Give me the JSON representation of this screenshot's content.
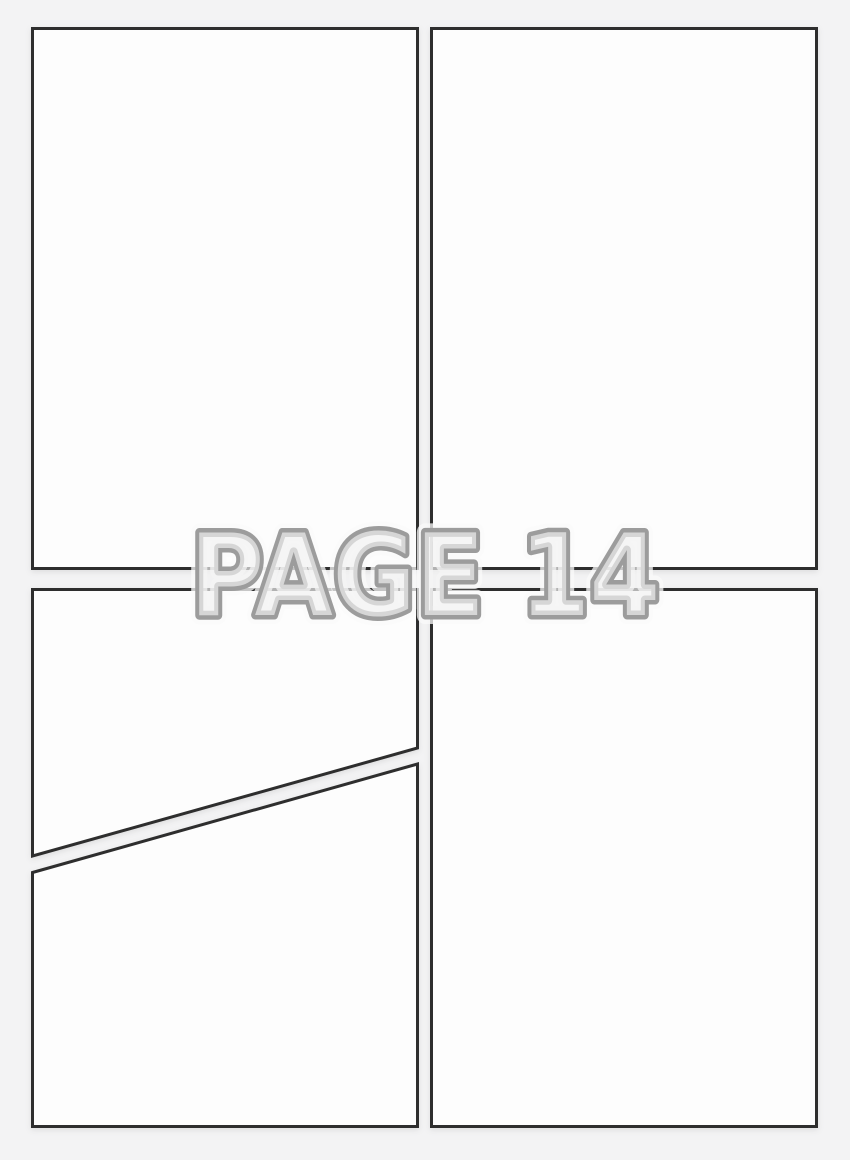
{
  "page": {
    "label": "PAGE 14",
    "colors": {
      "background": "#f3f3f4",
      "panel_fill": "#fdfdfd",
      "panel_border": "#2e2e2e",
      "label_fill": "#f1f1f2",
      "label_outline": "#9c9c9c",
      "label_halo": "#fafafa"
    },
    "panels": [
      {
        "id": "top-left"
      },
      {
        "id": "top-right"
      },
      {
        "id": "bottom-left-upper"
      },
      {
        "id": "bottom-left-lower"
      },
      {
        "id": "bottom-right"
      }
    ]
  }
}
